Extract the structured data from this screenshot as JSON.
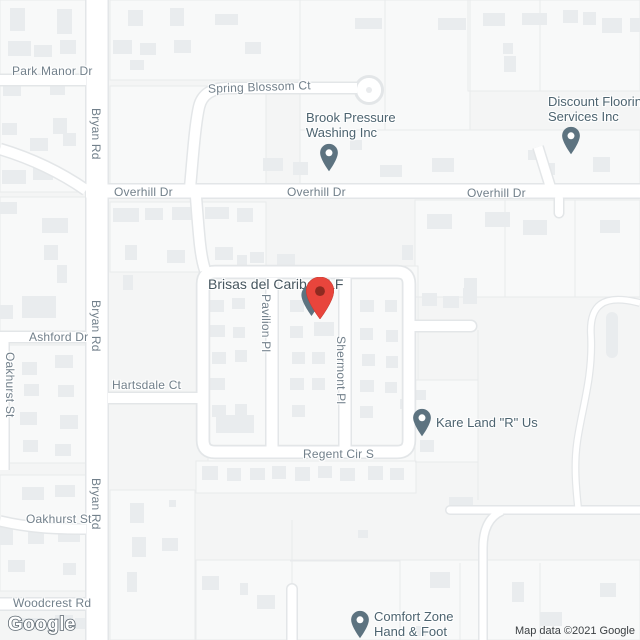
{
  "colors": {
    "building": "#e9ecee",
    "road-casing": "#e3e6e8",
    "street": "#72808b",
    "poi": "#4d6470",
    "poi-pin": "#5d7380",
    "marker-red": "#e8453c",
    "marker-red-inner": "#8e2a20",
    "attribution": "#3c4043"
  },
  "streets": {
    "park_manor": "Park Manor Dr",
    "spring_blossom": "Spring Blossom Ct",
    "overhill": "Overhill Dr",
    "bryan": "Bryan Rd",
    "ashford": "Ashford Dr",
    "oakhurst": "Oakhurst St",
    "hartsdale": "Hartsdale Ct",
    "pavilion": "Pavilion Pl",
    "shermont": "Shermont Pl",
    "regent": "Regent Cir S",
    "woodcrest": "Woodcrest Rd"
  },
  "places": {
    "brook": {
      "line1": "Brook Pressure",
      "line2": "Washing Inc"
    },
    "discount": {
      "line1": "Discount Flooring",
      "line2": "Services Inc"
    },
    "kare": {
      "line1": "Kare Land \"R\" Us"
    },
    "comfort": {
      "line1": "Comfort Zone",
      "line2": "Hand & Foot"
    },
    "brisas": {
      "label": "Brisas del Caribe ALF"
    }
  },
  "footer": {
    "logo": "Google",
    "attribution": "Map data ©2021 Google"
  }
}
